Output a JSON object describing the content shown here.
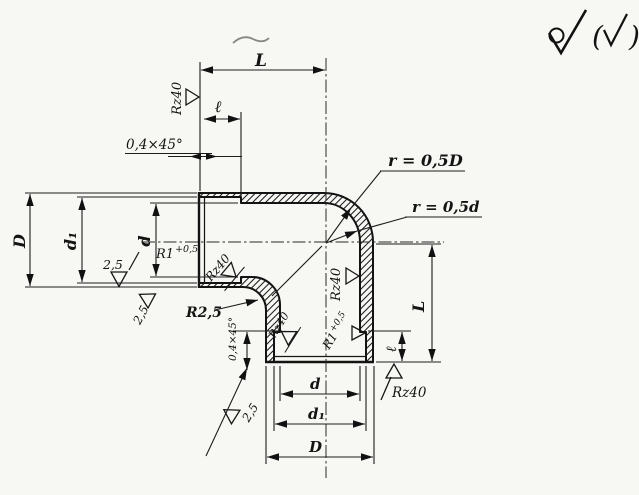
{
  "drawing": {
    "dims": {
      "L": "L",
      "l": "ℓ",
      "D": "D",
      "d": "d",
      "d1": "d₁"
    },
    "labels": {
      "chamfer": "0,4×45°",
      "radius_outer": "r = 0,5D",
      "radius_inner": "r = 0,5d",
      "fillet": "R2,5",
      "r1_base": "R1",
      "r1_sup": "+0,5",
      "rz": "Rz40",
      "roughness": "2,5"
    },
    "surface_finish": {
      "open": "(",
      "close": ")"
    }
  }
}
